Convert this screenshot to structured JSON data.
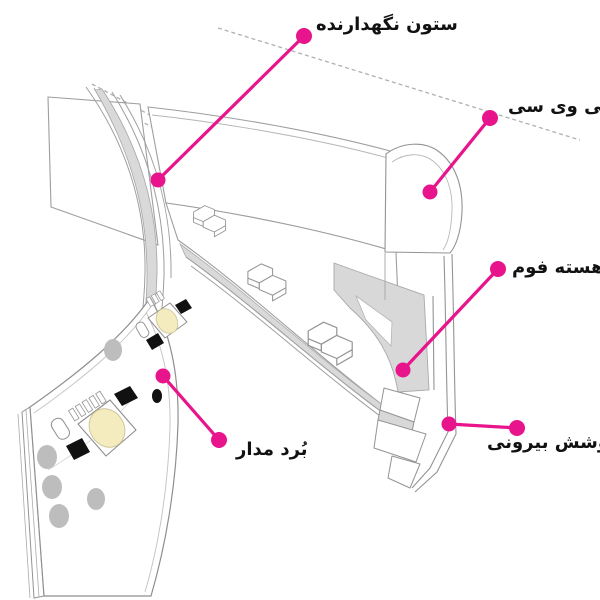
{
  "diagram": {
    "labels": [
      {
        "id": "support-column",
        "text": "ستون نگهدارنده"
      },
      {
        "id": "pvc",
        "text": "پی وی سی"
      },
      {
        "id": "foam-core",
        "text": "هسته فوم"
      },
      {
        "id": "outer-cover",
        "text": "پوشش بیرونی"
      },
      {
        "id": "circuit-board",
        "text": "بُرد مدار"
      }
    ],
    "colors": {
      "accent": "#E8148C",
      "line": "#9E9E9E",
      "shade": "#D9D9D9",
      "led_yellow": "#F4ECBF",
      "pad_gray": "#BDBDBD",
      "text": "#111111",
      "background": "#FFFFFF"
    }
  }
}
